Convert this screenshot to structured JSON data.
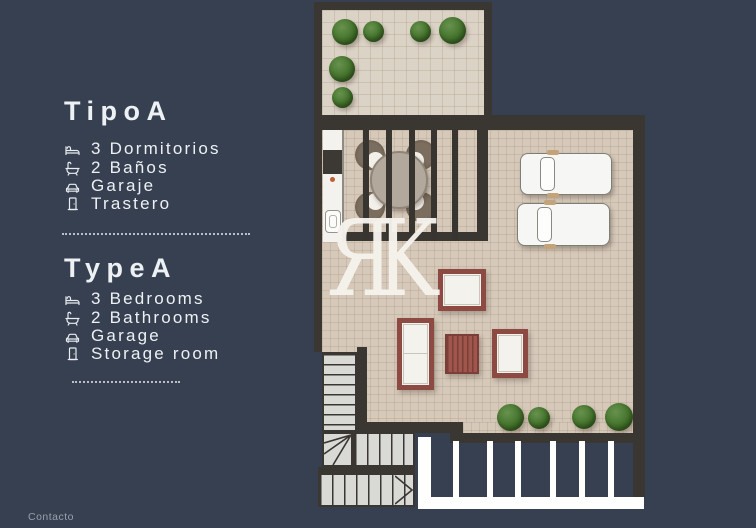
{
  "page": {
    "background_color": "#364051",
    "footer": {
      "label": "Contacto"
    }
  },
  "panel": {
    "sections": [
      {
        "id": "es",
        "title": "TipoA",
        "items": [
          {
            "icon": "bed-icon",
            "label": "3 Dormitorios"
          },
          {
            "icon": "bathtub-icon",
            "label": "2 Baños"
          },
          {
            "icon": "car-icon",
            "label": "Garaje"
          },
          {
            "icon": "door-icon",
            "label": "Trastero"
          }
        ]
      },
      {
        "id": "en",
        "title": "TypeA",
        "items": [
          {
            "icon": "bed-icon",
            "label": "3 Bedrooms"
          },
          {
            "icon": "bathtub-icon",
            "label": "2 Bathrooms"
          },
          {
            "icon": "car-icon",
            "label": "Garage"
          },
          {
            "icon": "door-icon",
            "label": "Storage room"
          }
        ]
      }
    ]
  },
  "watermark": {
    "text": "ЯK"
  },
  "floorplan": {
    "type": "apartment-floor-plan",
    "features_visible": {
      "terrace_plants": 6,
      "dining_seats": 4,
      "garage_cars": 2,
      "garden_plants": 4,
      "staircase": true,
      "white_fence": true
    },
    "colors": {
      "background": "#364051",
      "wall": "#3a3632",
      "floor": "#d6c9ba",
      "terrace_floor": "#dcd3c7",
      "furniture_accent": "#8c4a42",
      "plant_green": "#47762f",
      "fence_white": "#ffffff"
    }
  }
}
